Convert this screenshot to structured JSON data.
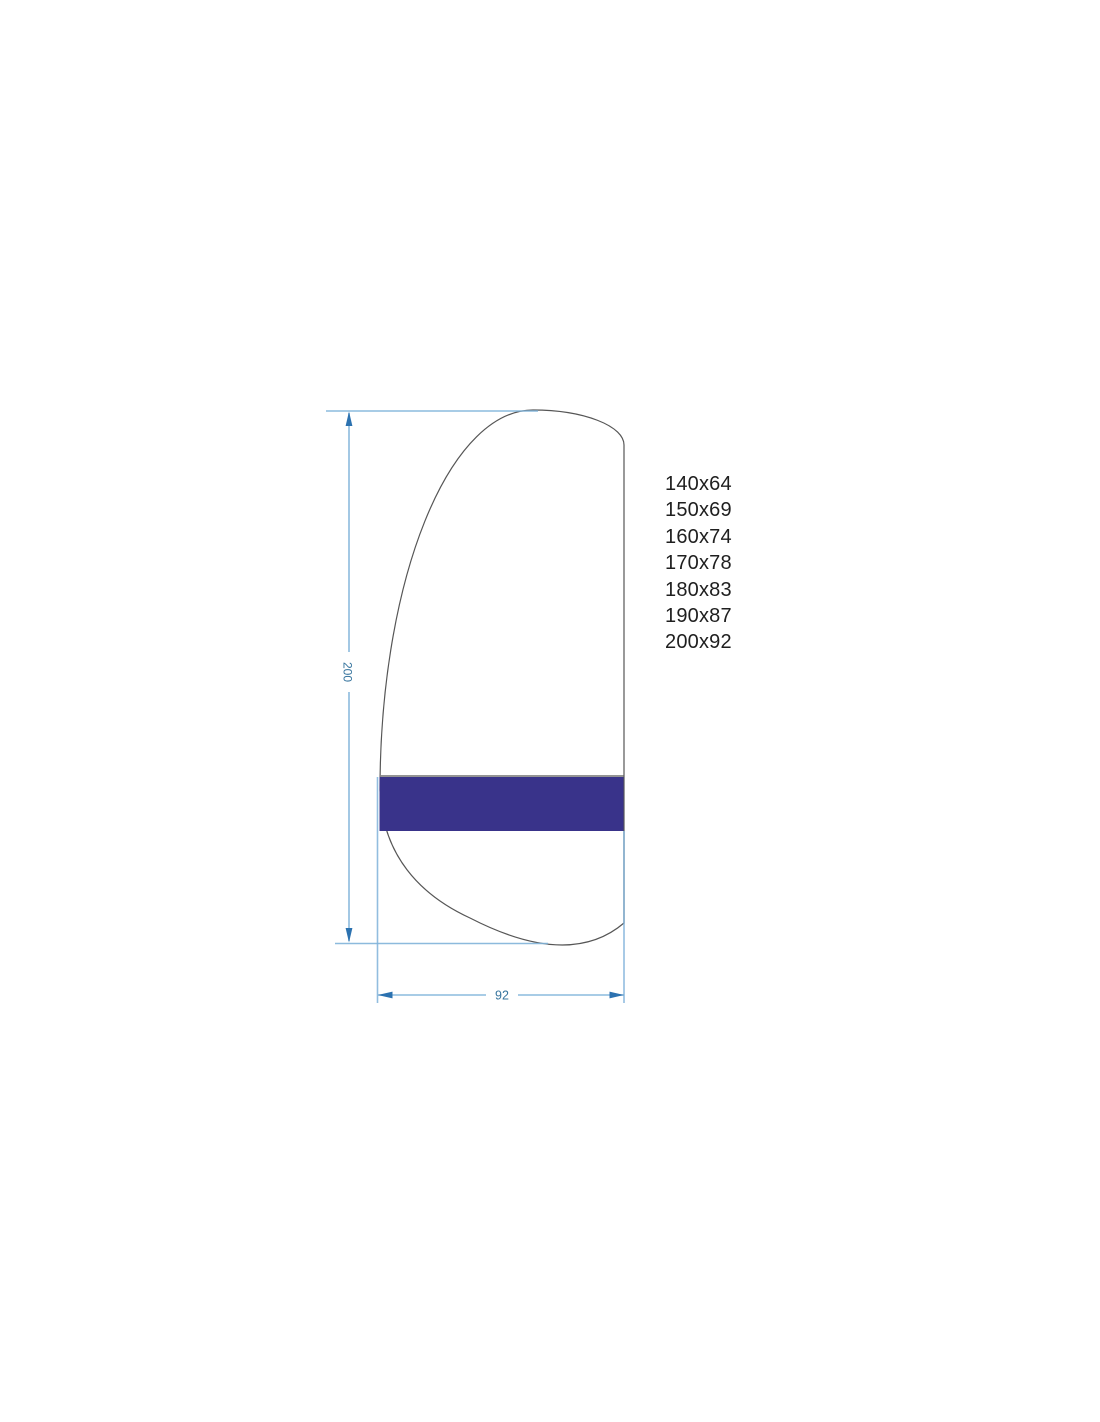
{
  "drawing": {
    "height_dimension": "200",
    "width_dimension": "92"
  },
  "sizes": [
    "140x64",
    "150x69",
    "160x74",
    "170x78",
    "180x83",
    "190x87",
    "200x92"
  ],
  "colors": {
    "band": "#39338a",
    "outline": "#565656",
    "band_edge": "#848484",
    "dim_line": "#7fb2d9",
    "dim_arrow": "#2c72b0",
    "dim_text": "#36749e"
  }
}
